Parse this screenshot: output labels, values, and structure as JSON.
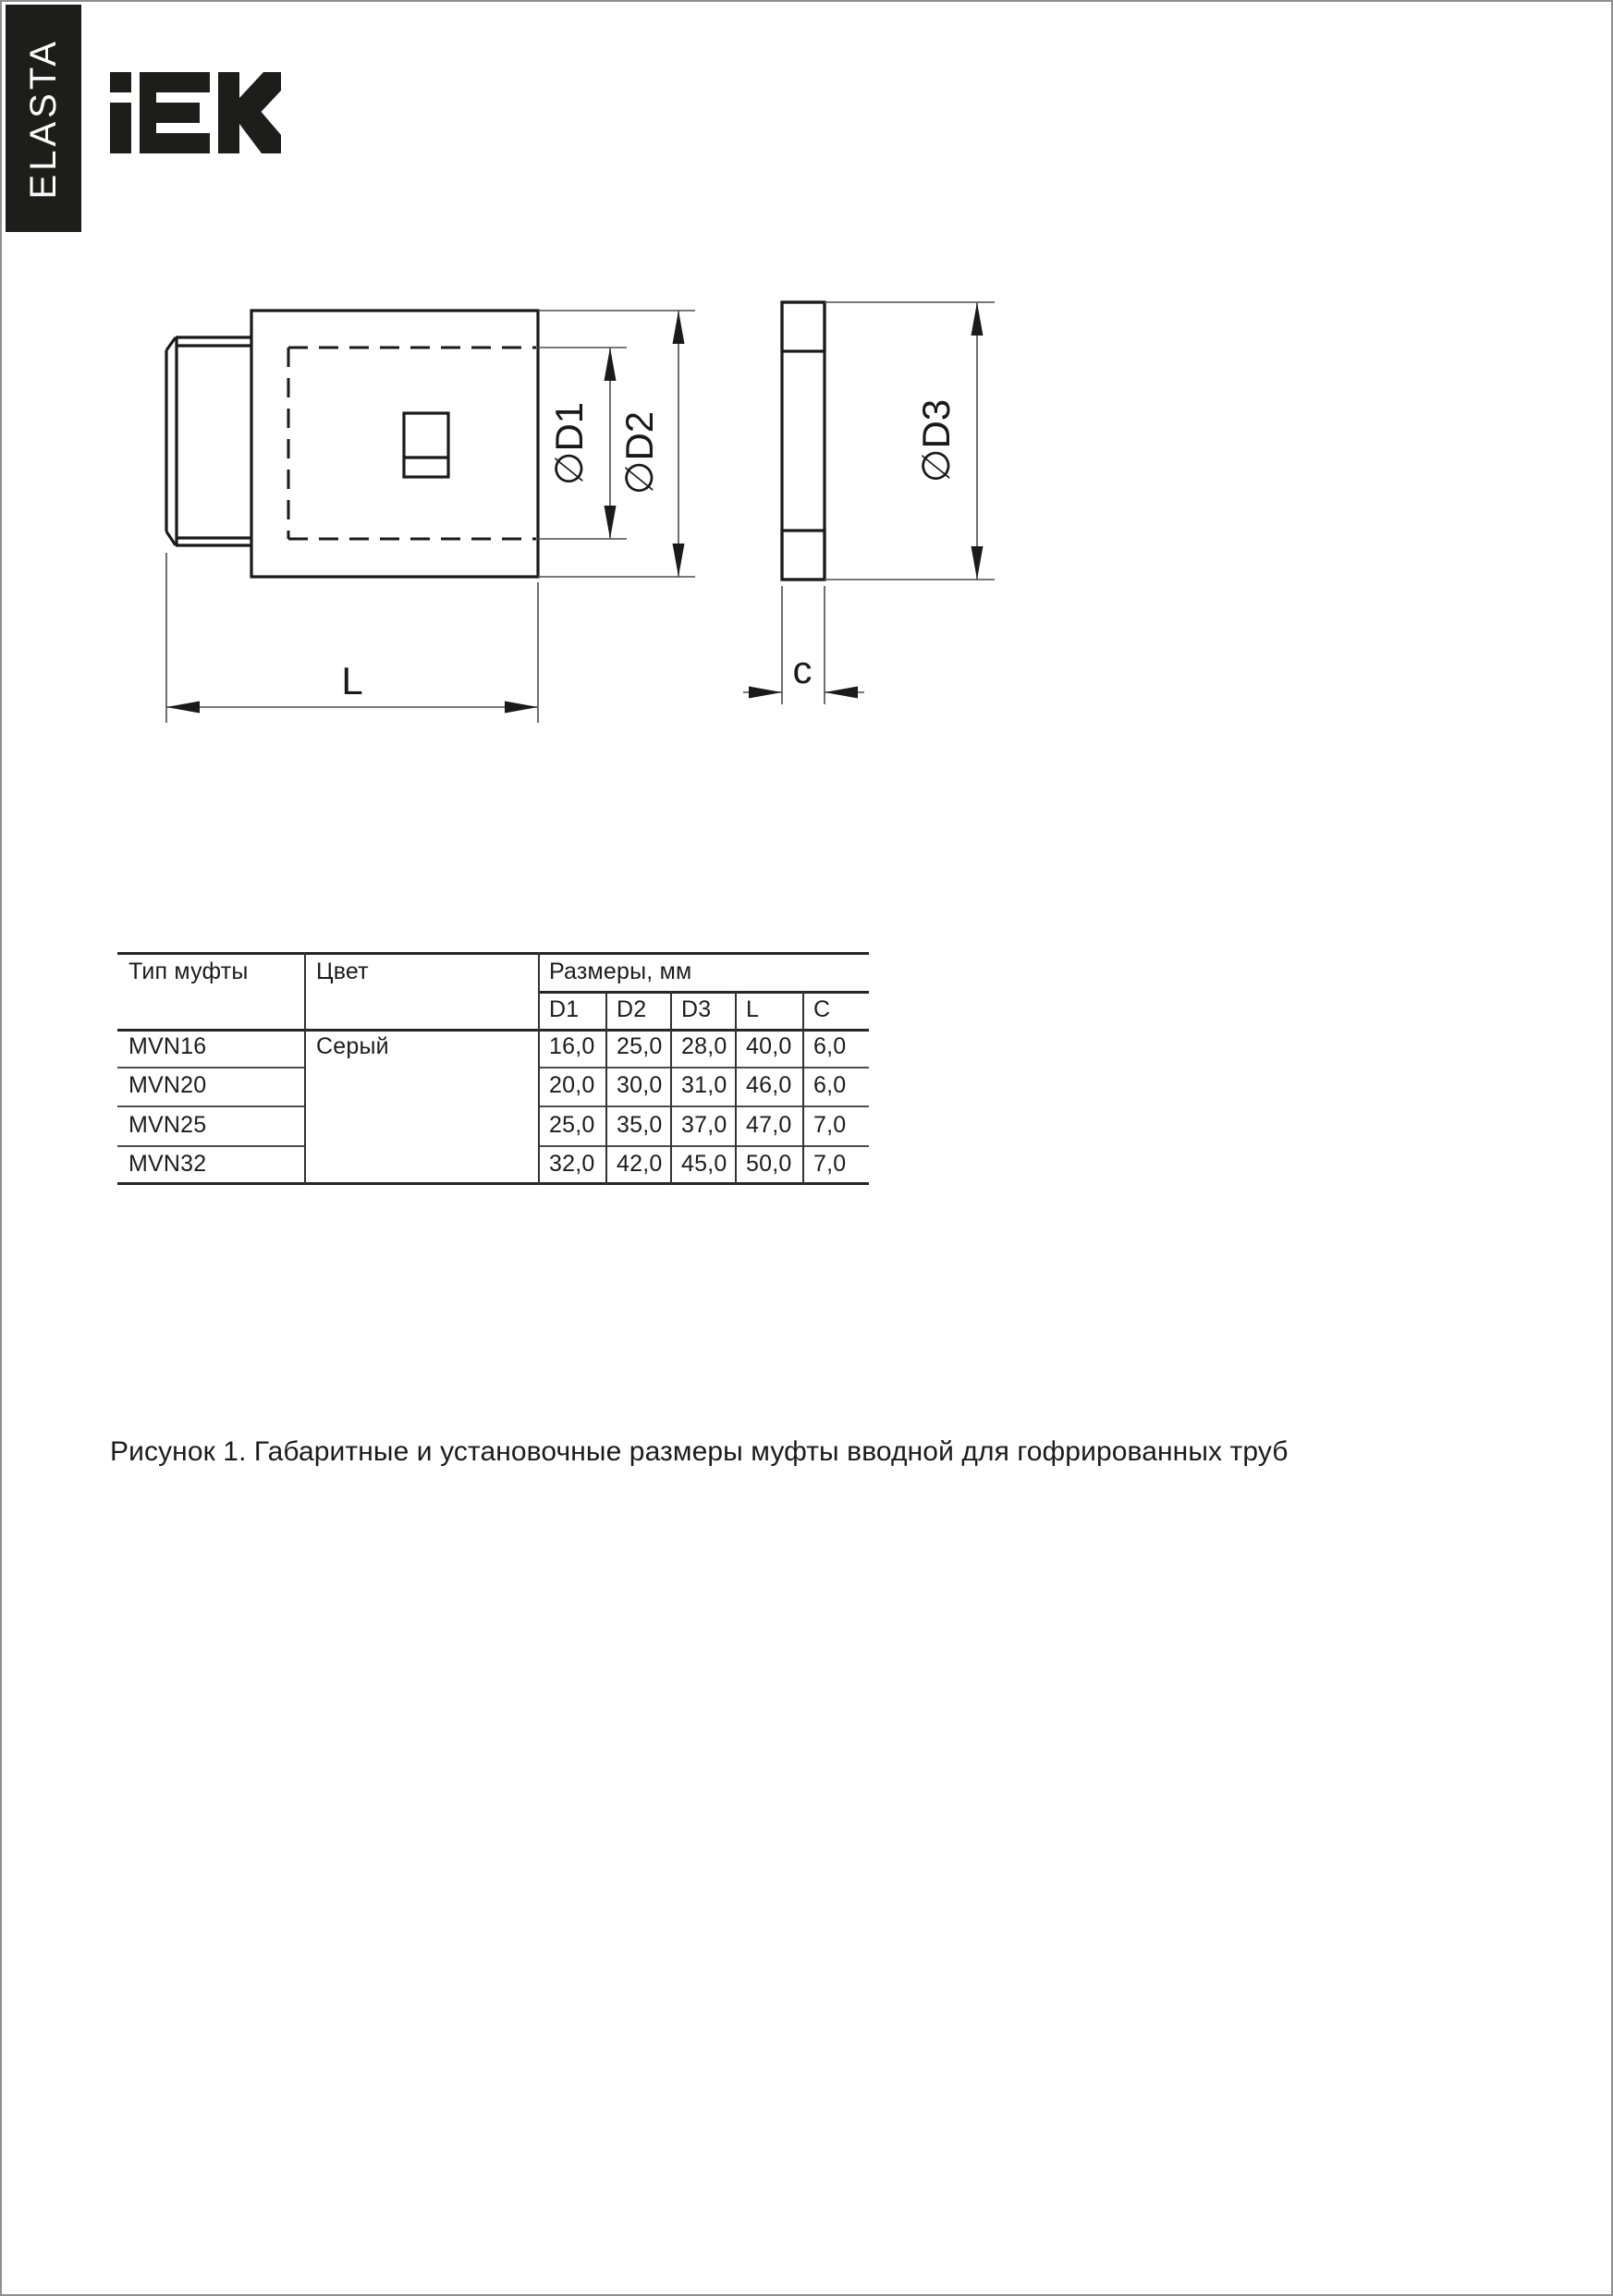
{
  "brand": {
    "side_label": "ELASTA",
    "logo_name": "IEK"
  },
  "colors": {
    "brand_black": "#1d1d1b",
    "page_border": "#8f8f8f",
    "line_black": "#1a1a1a",
    "thin_line": "#4d4d4d"
  },
  "drawing": {
    "labels": {
      "d1": "∅D1",
      "d2": "∅D2",
      "d3": "∅D3",
      "length": "L",
      "thickness": "c"
    }
  },
  "table": {
    "col1_header": "Тип муфты",
    "col2_header": "Цвет",
    "sizes_header": "Размеры, мм",
    "sub_headers": [
      "D1",
      "D2",
      "D3",
      "L",
      "C"
    ],
    "color_value": "Серый",
    "rows": [
      {
        "type": "MVN16",
        "values": [
          "16,0",
          "25,0",
          "28,0",
          "40,0",
          "6,0"
        ]
      },
      {
        "type": "MVN20",
        "values": [
          "20,0",
          "30,0",
          "31,0",
          "46,0",
          "6,0"
        ]
      },
      {
        "type": "MVN25",
        "values": [
          "25,0",
          "35,0",
          "37,0",
          "47,0",
          "7,0"
        ]
      },
      {
        "type": "MVN32",
        "values": [
          "32,0",
          "42,0",
          "45,0",
          "50,0",
          "7,0"
        ]
      }
    ]
  },
  "caption": "Рисунок 1. Габаритные и установочные размеры муфты вводной для гофрированных труб"
}
